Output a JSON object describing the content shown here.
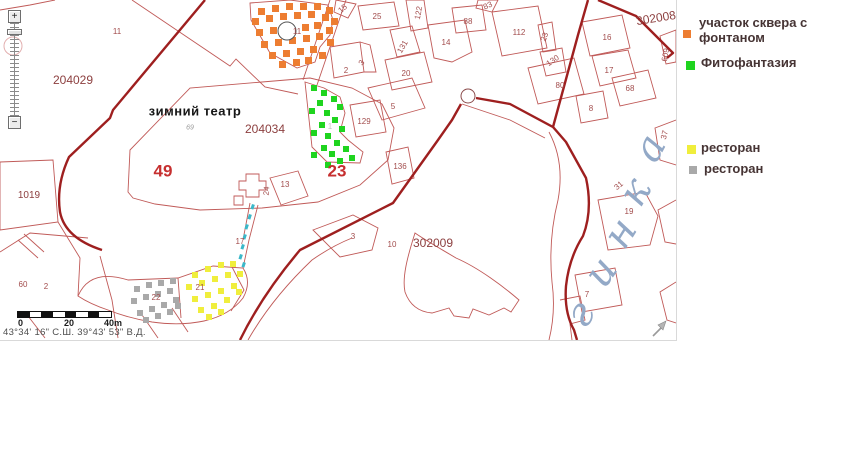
{
  "zoom_control": {
    "plus": "+",
    "minus": "−"
  },
  "map": {
    "width": 676,
    "height": 340,
    "colors": {
      "thin_line": "#c05a58",
      "thick_line": "#9e1f1f",
      "stream": "#3bb8c9",
      "orange": "#ed7d31",
      "green": "#1fd41f",
      "yellow": "#f0ee3c",
      "gray": "#a9a9a9",
      "river_text": "#93a9c7"
    },
    "lines": {
      "thin": [
        "M 0,10 L 30,5 L 55,0",
        "M 132,0 L 230,66 L 236,59 L 265,87 L 298,94",
        "M 128,192 L 130,150 L 190,88 L 262,82 L 310,78 L 352,88 L 382,104 L 394,128 L 388,160 L 360,185 L 318,202 L 262,208 L 200,210 L 155,204 L 133,198 Z",
        "M 246,174 h13 v7 h7 v9 h-7 v7 h-13 v-7 h-7 v-9 h7 Z",
        "M 234,196 h9 v9 h-9 Z",
        "M 270,178 L 298,171 L 308,196 L 281,205 Z",
        "M 258,205 L 249,240 L 243,268",
        "M 250,203 L 243,240",
        "M 78,296 Q 90,268 128,280 L 178,278 L 213,266 L 243,268 Q 252,282 243,298 Q 230,315 204,321 Q 180,326 152,322 Q 128,318 108,310 Q 90,304 78,296 Z",
        "M 178,278 L 181,318",
        "M 232,267 L 244,290 L 231,311",
        "M 0,162 L 53,160 L 58,222 L 0,230 Z",
        "M 0,252 L 30,233 L 88,238",
        "M 18,240 L 38,258 M 24,234 L 44,252",
        "M 58,222 L 80,258 L 78,296",
        "M 28,316 L 45,338",
        "M 140,312 L 158,338",
        "M 172,308 L 188,332",
        "M 100,256 L 112,300 L 118,338",
        "M 330,0 L 303,80 M 346,0 L 317,85",
        "M 250,3 L 290,0 L 328,5 L 333,20 L 330,35 L 320,47 L 315,62 L 297,68 L 270,53 L 251,20 Z",
        "M 305,82 L 324,88 L 340,97 L 345,113 L 340,132 L 348,140 L 363,152 L 360,163 L 327,162 L 312,147 L 308,110 Z",
        "M 330,47 L 360,42 L 364,72 L 334,78 Z",
        "M 360,42 L 370,45 L 376,72 L 364,72",
        "M 368,88 L 412,78 L 425,108 L 382,120 Z",
        "M 385,60 L 424,52 L 432,82 L 392,90 Z",
        "M 390,30 L 412,26 L 420,52 L 397,57 Z",
        "M 358,6 L 394,2 L 399,26 L 363,30 Z",
        "M 406,0 L 424,0 L 428,28 L 411,31 Z",
        "M 336,0 L 356,4 L 348,18 L 334,12 Z",
        "M 452,8 L 482,5 L 486,30 L 456,33 Z",
        "M 478,0 L 498,0 L 492,12 L 476,8 Z",
        "M 428,25 L 465,20 L 472,52 L 452,62 L 434,58 Z",
        "M 386,152 L 408,147 L 414,178 L 392,184 Z",
        "M 350,105 L 380,100 L 386,132 L 356,137 Z",
        "M 492,12 L 538,6 L 547,48 L 502,56 Z",
        "M 538,25 L 552,22 L 556,50 L 543,52 Z",
        "M 540,52 L 562,48 L 566,72 L 546,76 Z",
        "M 528,68 L 574,58 L 584,94 L 538,104 Z",
        "M 582,22 L 622,15 L 630,48 L 590,56 Z",
        "M 592,56 L 628,50 L 636,78 L 600,86 Z",
        "M 612,78 L 648,70 L 656,98 L 620,106 Z",
        "M 576,96 L 603,91 L 608,118 L 581,123 Z",
        "M 660,36 L 676,30 L 676,62 L 666,64 Z",
        "M 415,233 C 407,258 402,278 405,292 C 410,306 420,312 432,313 L 449,308 L 454,316 L 469,318 L 473,309 L 489,315 L 504,308 L 511,312 L 519,300 C 504,287 479,268 456,258 C 441,249 425,240 415,233 Z",
        "M 313,230 L 353,215 L 378,228 L 372,250 L 340,257 Z",
        "M 248,340 Q 272,298 312,260 Q 332,246 352,238",
        "M 549,132 Q 565,162 558,200 Q 548,240 552,282 Q 556,312 549,340",
        "M 598,200 L 645,192 L 658,216 L 650,245 L 608,250 Z",
        "M 575,275 L 615,268 L 622,305 L 582,312 Z",
        "M 560,300 L 580,296 L 585,320 L 570,324 L 572,340",
        "M 676,120 L 655,128 L 660,160 L 676,165",
        "M 676,200 L 658,210 L 665,242 L 676,244",
        "M 676,282 L 660,292 L 667,320 L 676,323",
        "M 462,104 L 510,120 L 545,138"
      ],
      "thick": [
        "M 205,0 L 113,110 L 110,118 L 69,157 Q 56,185 60,212 Q 65,238 102,250",
        "M 240,340 Q 262,295 300,250 L 393,203 L 438,140 L 452,120 L 461,104",
        "M 476,98 L 510,104 L 553,127",
        "M 553,127 L 578,35 L 588,0",
        "M 553,127 L 566,142 L 586,178 Q 593,210 583,236 Q 569,258 566,286 Q 564,312 574,330 L 577,340",
        "M 598,0 L 636,16 L 673,53 L 667,58"
      ]
    },
    "circles": [
      {
        "cx": 468,
        "cy": 96,
        "r": 7,
        "stroke": "#8a4a4a",
        "fill": "none"
      },
      {
        "cx": 287,
        "cy": 31,
        "r": 9,
        "stroke": "#555555",
        "fill": "#ffffff"
      },
      {
        "cx": 13,
        "cy": 46,
        "r": 9,
        "stroke": "#e3b0b0",
        "fill": "none"
      }
    ],
    "areas": [
      {
        "name": "fountain-square-area",
        "color": "#ed7d31",
        "size": 7,
        "squares": [
          [
            258,
            8
          ],
          [
            272,
            5
          ],
          [
            286,
            3
          ],
          [
            300,
            3
          ],
          [
            314,
            3
          ],
          [
            326,
            7
          ],
          [
            252,
            18
          ],
          [
            266,
            15
          ],
          [
            280,
            13
          ],
          [
            294,
            12
          ],
          [
            308,
            11
          ],
          [
            322,
            14
          ],
          [
            331,
            18
          ],
          [
            256,
            29
          ],
          [
            270,
            27
          ],
          [
            302,
            24
          ],
          [
            314,
            22
          ],
          [
            326,
            27
          ],
          [
            261,
            41
          ],
          [
            275,
            39
          ],
          [
            289,
            37
          ],
          [
            303,
            35
          ],
          [
            316,
            33
          ],
          [
            327,
            39
          ],
          [
            269,
            52
          ],
          [
            283,
            50
          ],
          [
            297,
            48
          ],
          [
            310,
            46
          ],
          [
            319,
            52
          ],
          [
            279,
            61
          ],
          [
            293,
            59
          ],
          [
            305,
            57
          ]
        ]
      },
      {
        "name": "fitofantasia-area",
        "color": "#1fd41f",
        "size": 6,
        "squares": [
          [
            311,
            85
          ],
          [
            321,
            90
          ],
          [
            331,
            96
          ],
          [
            317,
            100
          ],
          [
            309,
            108
          ],
          [
            324,
            110
          ],
          [
            337,
            104
          ],
          [
            332,
            117
          ],
          [
            319,
            122
          ],
          [
            311,
            130
          ],
          [
            325,
            133
          ],
          [
            339,
            126
          ],
          [
            334,
            140
          ],
          [
            321,
            145
          ],
          [
            311,
            152
          ],
          [
            329,
            151
          ],
          [
            343,
            146
          ],
          [
            349,
            155
          ],
          [
            337,
            158
          ],
          [
            325,
            162
          ]
        ]
      },
      {
        "name": "restaurant-yellow-area",
        "color": "#f0ee3c",
        "size": 6,
        "squares": [
          [
            192,
            272
          ],
          [
            205,
            266
          ],
          [
            218,
            262
          ],
          [
            230,
            261
          ],
          [
            186,
            284
          ],
          [
            199,
            280
          ],
          [
            212,
            276
          ],
          [
            225,
            272
          ],
          [
            237,
            271
          ],
          [
            192,
            296
          ],
          [
            205,
            292
          ],
          [
            218,
            288
          ],
          [
            231,
            283
          ],
          [
            198,
            307
          ],
          [
            211,
            303
          ],
          [
            224,
            297
          ],
          [
            236,
            289
          ],
          [
            206,
            314
          ],
          [
            218,
            309
          ]
        ]
      },
      {
        "name": "restaurant-gray-area",
        "color": "#a9a9a9",
        "size": 6,
        "squares": [
          [
            134,
            286
          ],
          [
            146,
            282
          ],
          [
            158,
            280
          ],
          [
            170,
            278
          ],
          [
            131,
            298
          ],
          [
            143,
            294
          ],
          [
            155,
            291
          ],
          [
            167,
            288
          ],
          [
            137,
            310
          ],
          [
            149,
            306
          ],
          [
            161,
            302
          ],
          [
            173,
            297
          ],
          [
            143,
            317
          ],
          [
            155,
            313
          ],
          [
            167,
            309
          ],
          [
            175,
            303
          ]
        ]
      }
    ],
    "stream_dashes": [
      [
        252,
        204
      ],
      [
        249,
        214
      ],
      [
        246,
        224
      ],
      [
        244,
        234
      ],
      [
        242,
        244
      ],
      [
        240,
        254
      ],
      [
        243,
        262
      ]
    ],
    "labels": [
      [
        "11",
        117,
        32,
        "s",
        0
      ],
      [
        "204029",
        73,
        80,
        "z",
        0
      ],
      [
        "зимний театр",
        195,
        111,
        "b",
        0
      ],
      [
        "69",
        190,
        128,
        "t",
        0
      ],
      [
        "204034",
        265,
        129,
        "z",
        0
      ],
      [
        "49",
        163,
        171,
        "g",
        0
      ],
      [
        "1019",
        29,
        196,
        "zs",
        0
      ],
      [
        "60",
        23,
        285,
        "s",
        0
      ],
      [
        "2",
        46,
        287,
        "s",
        0
      ],
      [
        "22",
        156,
        298,
        "s",
        0
      ],
      [
        "21",
        200,
        288,
        "s",
        0
      ],
      [
        "17",
        240,
        242,
        "s",
        0
      ],
      [
        "24",
        267,
        191,
        "s",
        -85
      ],
      [
        "13",
        285,
        185,
        "s",
        0
      ],
      [
        "11",
        297,
        32,
        "s",
        0
      ],
      [
        "15",
        343,
        9,
        "s",
        -40
      ],
      [
        "25",
        377,
        17,
        "s",
        0
      ],
      [
        "122",
        419,
        13,
        "s",
        -80
      ],
      [
        "83",
        488,
        6,
        "s",
        -25
      ],
      [
        "88",
        468,
        22,
        "s",
        0
      ],
      [
        "14",
        446,
        43,
        "s",
        0
      ],
      [
        "131",
        403,
        47,
        "s",
        -60
      ],
      [
        "3",
        362,
        63,
        "s",
        -55
      ],
      [
        "2",
        346,
        71,
        "s",
        0
      ],
      [
        "20",
        406,
        74,
        "s",
        0
      ],
      [
        "5",
        393,
        107,
        "s",
        0
      ],
      [
        "129",
        364,
        122,
        "s",
        0
      ],
      [
        "1",
        330,
        127,
        "f",
        0
      ],
      [
        "23",
        337,
        171,
        "g",
        0
      ],
      [
        "136",
        400,
        167,
        "s",
        0
      ],
      [
        "3",
        353,
        237,
        "s",
        0
      ],
      [
        "10",
        392,
        245,
        "s",
        0
      ],
      [
        "302009",
        433,
        243,
        "z",
        0
      ],
      [
        "302008",
        656,
        18,
        "z",
        -9
      ],
      [
        "112",
        519,
        33,
        "s",
        0
      ],
      [
        "23",
        545,
        37,
        "s",
        -70
      ],
      [
        "130",
        553,
        61,
        "s",
        -35
      ],
      [
        "80",
        560,
        86,
        "s",
        0
      ],
      [
        "16",
        607,
        38,
        "s",
        0
      ],
      [
        "17",
        609,
        71,
        "s",
        0
      ],
      [
        "68",
        630,
        89,
        "s",
        0
      ],
      [
        "8",
        591,
        109,
        "s",
        0
      ],
      [
        "609",
        666,
        55,
        "s",
        -78
      ],
      [
        "37",
        665,
        135,
        "s",
        -75
      ],
      [
        "31",
        619,
        186,
        "s",
        -40
      ],
      [
        "19",
        629,
        212,
        "s",
        0
      ],
      [
        "7",
        587,
        295,
        "s",
        0
      ]
    ],
    "river_name": {
      "letters": [
        [
          "г",
          584,
          316,
          -52
        ],
        [
          "и",
          602,
          274,
          -55
        ],
        [
          "н",
          621,
          235,
          -58
        ],
        [
          "к",
          637,
          194,
          -60
        ],
        [
          "а",
          652,
          150,
          -62
        ]
      ]
    },
    "scalebar": {
      "x": 17,
      "y": 311,
      "width": 93,
      "height": 5,
      "segments": 8,
      "labels": [
        [
          "0",
          18
        ],
        [
          "20",
          64
        ],
        [
          "40m",
          104
        ]
      ],
      "label_y": 319
    },
    "coordinates_text": "43°34' 16\" С.Ш.  39°43' 53\" В.Д.",
    "coordinates_pos": [
      3,
      327
    ],
    "cursor_pos": [
      651,
      318
    ]
  },
  "legend": {
    "items": [
      {
        "color": "#ed7d31",
        "lines": [
          "участок сквера с",
          "фонтаном"
        ],
        "sx": 683,
        "sy": 30,
        "ss": 8,
        "tx": 699,
        "ty": 15
      },
      {
        "color": "#1fd41f",
        "lines": [
          "Фитофантазия"
        ],
        "sx": 686,
        "sy": 61,
        "ss": 9,
        "tx": 701,
        "ty": 55
      },
      {
        "color": "#f0ee3c",
        "lines": [
          "ресторан"
        ],
        "sx": 687,
        "sy": 145,
        "ss": 9,
        "tx": 701,
        "ty": 140
      },
      {
        "color": "#a9a9a9",
        "lines": [
          "ресторан"
        ],
        "sx": 689,
        "sy": 166,
        "ss": 8,
        "tx": 704,
        "ty": 161
      }
    ]
  }
}
